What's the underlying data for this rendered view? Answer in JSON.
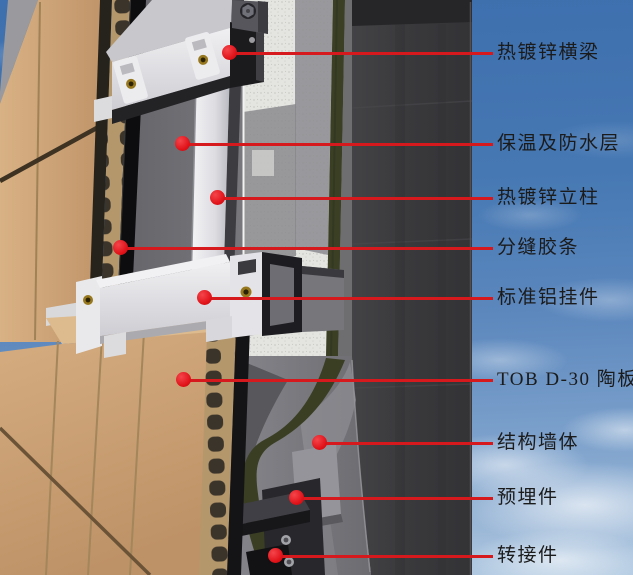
{
  "diagram": {
    "type": "curtain-wall-facade-detail",
    "annotations": [
      {
        "id": "galvanized-crossbeam",
        "label": "热镀锌横梁"
      },
      {
        "id": "insulation-waterproof-layer",
        "label": "保温及防水层"
      },
      {
        "id": "galvanized-column",
        "label": "热镀锌立柱"
      },
      {
        "id": "joint-rubber-strip",
        "label": "分缝胶条"
      },
      {
        "id": "standard-aluminum-hanger",
        "label": "标准铝挂件"
      },
      {
        "id": "tob-d30-ceramic-panel",
        "label": "TOB D-30 陶板"
      },
      {
        "id": "structural-wall",
        "label": "结构墙体"
      },
      {
        "id": "embedded-part",
        "label": "预埋件"
      },
      {
        "id": "adapter-connector",
        "label": "转接件"
      }
    ],
    "colors": {
      "callout_red": "#e01118",
      "leader_line_red": "#d6191d",
      "label_text": "#1b1b1b",
      "ceramic_panel_tan": "#cda57a",
      "insulation_white": "#e4e4e1",
      "membrane_olive": "#3b3f24",
      "structural_wall_dark": "#3a3a3d",
      "metal_frame_white": "#e9e9ec",
      "sky_blue": "#4678b3"
    }
  }
}
